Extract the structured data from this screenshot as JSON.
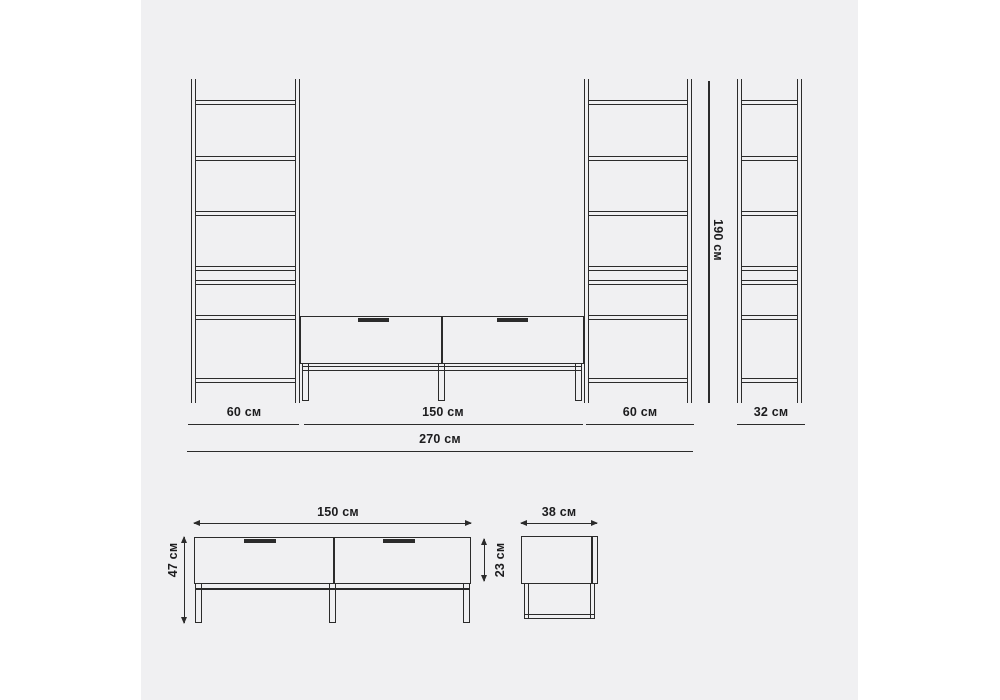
{
  "colors": {
    "page_bg": "#ffffff",
    "canvas_bg": "#f0f0f2",
    "ink": "#2b2b2b",
    "label_color": "#1c1c1e"
  },
  "elevation": {
    "left_shelf_width": "60 см",
    "tv_stand_width": "150 см",
    "right_shelf_width": "60 см",
    "side_shelf_depth": "32 см",
    "total_width": "270 см",
    "shelf_height": "190 см"
  },
  "front_view": {
    "width": "150 см",
    "height": "47 см",
    "drawer_height": "23 см"
  },
  "side_view": {
    "depth": "38 см"
  }
}
